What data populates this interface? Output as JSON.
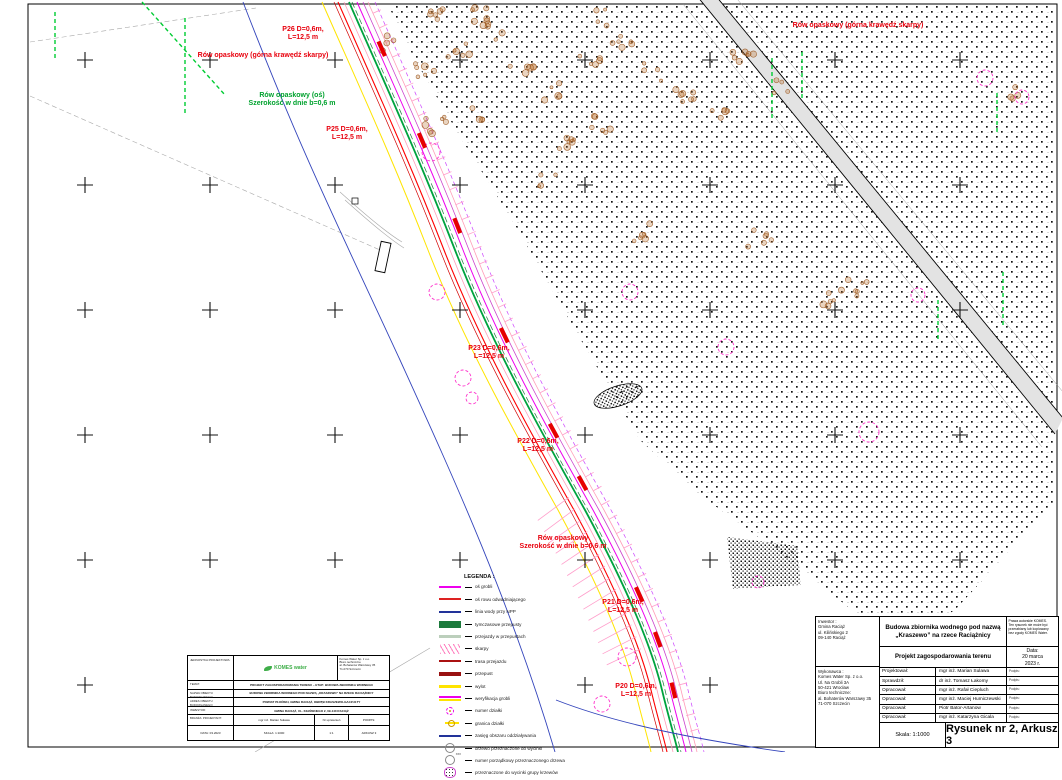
{
  "map": {
    "annotations": [
      {
        "lines": [
          "P26 D=0,6m,",
          "L=12,5 m"
        ],
        "x": 303,
        "y": 26,
        "color": "red"
      },
      {
        "lines": [
          "Rów opaskowy (górna krawędź skarpy)"
        ],
        "x": 263,
        "y": 52,
        "color": "red"
      },
      {
        "lines": [
          "Rów opaskowy (oś)",
          "Szerokość w dnie b=0,6 m"
        ],
        "x": 292,
        "y": 92,
        "color": "green"
      },
      {
        "lines": [
          "P25 D=0,6m,",
          "L=12,5 m"
        ],
        "x": 347,
        "y": 126,
        "color": "red"
      },
      {
        "lines": [
          "P23 D=0,6m,",
          "L=12,5 m"
        ],
        "x": 489,
        "y": 345,
        "color": "red"
      },
      {
        "lines": [
          "P22 D=0,6m,",
          "L=12,5 m"
        ],
        "x": 538,
        "y": 438,
        "color": "red"
      },
      {
        "lines": [
          "Rów opaskowy",
          "Szerokość w dnie b=0,6 m"
        ],
        "x": 563,
        "y": 535,
        "color": "red"
      },
      {
        "lines": [
          "P21 D=0,6m,",
          "L=12,5 m"
        ],
        "x": 623,
        "y": 599,
        "color": "red"
      },
      {
        "lines": [
          "P20 D=0,6m,",
          "L=12,5 m"
        ],
        "x": 636,
        "y": 683,
        "color": "red"
      },
      {
        "lines": [
          "Rów opaskowy (górna krawędź skarpy)"
        ],
        "x": 858,
        "y": 22,
        "color": "red"
      }
    ]
  },
  "legend": {
    "title": "LEGENDA :",
    "items": [
      {
        "swatch": "line-magenta",
        "label": "oś grobli"
      },
      {
        "swatch": "line-red",
        "label": "oś rowu odwadniającego"
      },
      {
        "swatch": "line-navy",
        "label": "linia wody przy NPP"
      },
      {
        "swatch": "rect-green",
        "label": "tymczasowe przepusty"
      },
      {
        "swatch": "line-pale",
        "label": "przejazdy w przepustach"
      },
      {
        "swatch": "hatch-pink",
        "label": "skarpy"
      },
      {
        "swatch": "line-darkred",
        "label": "trasa przejazdu"
      },
      {
        "swatch": "line-darkred-thick",
        "label": "przepust"
      },
      {
        "swatch": "line-yellow",
        "label": "wylot"
      },
      {
        "swatch": "line-magenta-yellow",
        "label": "weryfikacja grobli"
      },
      {
        "swatch": "circle-magenta",
        "label": "numer działki"
      },
      {
        "swatch": "circle-yellow",
        "label": "granica działki"
      },
      {
        "swatch": "line-navy",
        "label": "zasięg obszaru oddziaływania"
      },
      {
        "swatch": "circle-outline",
        "label": "drzewo przeznaczone do wycinki"
      },
      {
        "swatch": "circle-numbered",
        "label": "numer porządkowy przeznaczonego drzewa"
      },
      {
        "swatch": "blob-hatch",
        "label": "przeznaczone do wycinki grupy krzewów"
      }
    ]
  },
  "small_title_block": {
    "unit_label": "JEDNOSTKA PROJEKTOWA:",
    "logo_text": "KOMES water",
    "address_lines": [
      "Komes Water Sp. z o.o.",
      "Biuro techniczne",
      "al. Bohaterów Warszawy 35",
      "71-070 Szczecin"
    ],
    "rows": [
      {
        "label": "TEMAT:",
        "value": "PROJEKT ZAGOSPODAROWANIA TERENU – ETAP: BUDOWA ZBIORNIKA WODNEGO"
      },
      {
        "label": "NAZWA OBIEKTU BUDOWLANEGO:",
        "value": "BUDOWA ZBIORNIKA WODNEGO POD NAZWĄ „KRASZEWO” NA RZECE RACIĄŻNICY"
      },
      {
        "label": "ADRES OBIEKTU BUDOWLANEGO:",
        "value": "POWIAT PŁOŃSKI, GMINA RACIĄŻ, OBRĘB KRASZEWO-GACZUŁTY"
      },
      {
        "label": "INWESTOR:",
        "value": "GMINA RACIĄŻ, UL. KILIŃSKIEGO 2, 09-140 RACIĄŻ"
      }
    ],
    "row6": [
      "BRANŻA: PROJEKTANT:",
      "mgr inż. Marian Sulawa",
      "Nr uprawnień",
      "PODPIS:"
    ],
    "row7": [
      "DATA: 03.2023",
      "SKALA: 1:1000",
      "1:1",
      "ARKUSZ 3"
    ]
  },
  "title_block": {
    "investor_lines": [
      "Inwestor :",
      "Gmina Raciąż",
      "ul. Kilińskiego 2",
      "09-140 Raciąż"
    ],
    "contractor_lines": [
      "Wykonawca :",
      "Komes Water Sp. z o.o.",
      "Ul. Na Grobli 3A",
      "50-421 Wrocław",
      "Biuro techniczne:",
      "al. Bohaterów Warszawy 35",
      "71-070 Szczecin"
    ],
    "project_title_lines": [
      "Budowa zbiornika wodnego pod nazwą",
      "„Kraszewo” na rzece Raciążnicy"
    ],
    "copyright_lines": [
      "Prawa autorskie KOMES.",
      "Ten rysunek nie może być",
      "przerabiany lub kopiowany",
      "bez zgody KOMES Water."
    ],
    "subtitle": "Projekt zagospodarowania terenu",
    "date_lines": [
      "Data:",
      "20 marca",
      "2023 r."
    ],
    "roles": [
      {
        "role": "Projektował:",
        "name": "mgr inż. Marian Sulawa"
      },
      {
        "role": "Sprawdził:",
        "name": "dr inż. Tomasz Łakomy"
      },
      {
        "role": "Opracował:",
        "name": "mgr inż. Rafał Ciepluch"
      },
      {
        "role": "Opracował:",
        "name": "mgr inż. Maciej Humiczewski"
      },
      {
        "role": "Opracował:",
        "name": "Piotr Bator-Artanow"
      },
      {
        "role": "Opracował:",
        "name": "mgr inż. Katarzyna Gicala"
      }
    ],
    "signature_label": "Podpis:",
    "scale": "Skala: 1:1000",
    "drawing_no": "Rysunek nr 2, Arkusz 3"
  },
  "colors": {
    "annotation_red": "#e8000d",
    "annotation_green": "#00a22e",
    "corridor_green": "#00a33e",
    "corridor_magenta": "#ee00ee",
    "corridor_red": "#e60000",
    "water_blue": "#3344bb",
    "logo_green": "#3fae49"
  }
}
